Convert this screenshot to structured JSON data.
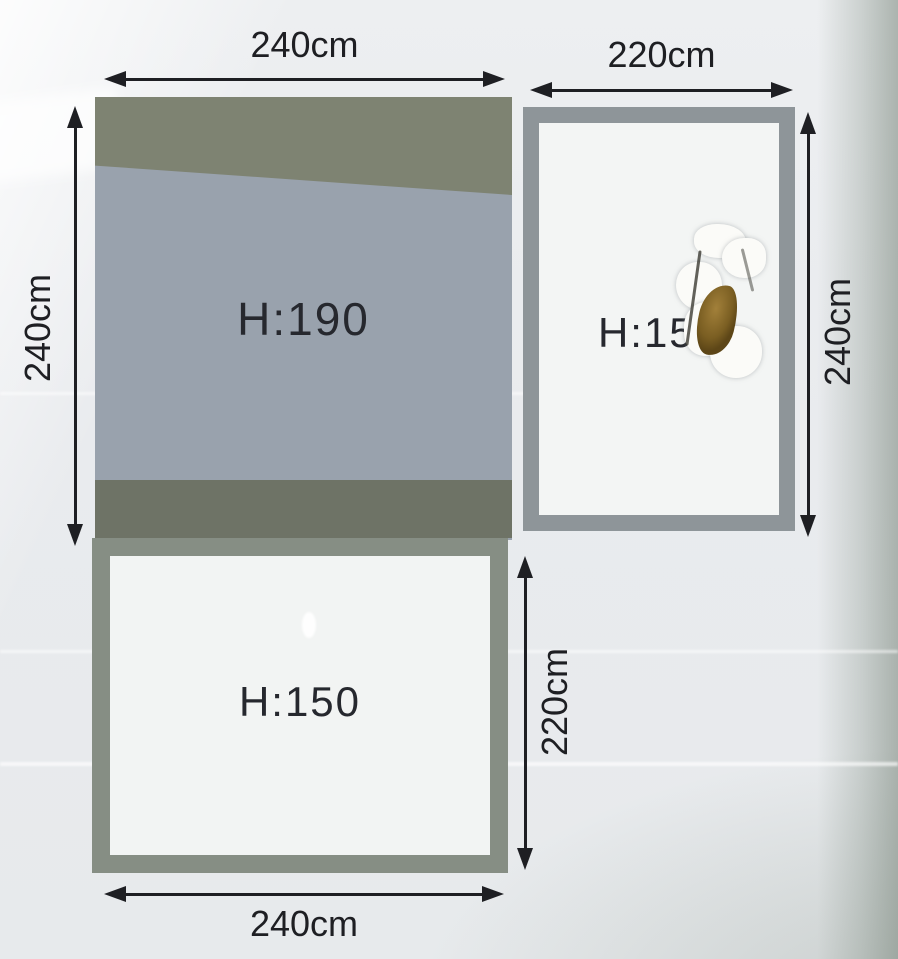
{
  "image": {
    "kind": "package dimension diagram photographed through plastic wrap",
    "background_color": "#e9ebee",
    "ink_color": "#1e1f23"
  },
  "panels": {
    "top_left": {
      "height_label": "H:190",
      "style": "filled",
      "fill": "#99a2ad",
      "top_band": "#7e8372",
      "bottom_band": "#6e7366"
    },
    "top_right": {
      "height_label": "H:150",
      "style": "outlined",
      "border": "#8e9599",
      "interior": "#f3f5f4"
    },
    "bottom_left": {
      "height_label": "H:150",
      "style": "outlined",
      "border": "#868e84",
      "interior": "#f2f4f3"
    }
  },
  "dims": {
    "top_left_width": "240cm",
    "top_right_width": "220cm",
    "left_height": "240cm",
    "right_height": "240cm",
    "middle_height": "220cm",
    "bottom_width": "240cm"
  },
  "defects": {
    "tear": "torn wrap patch with brown spot over right panel label"
  }
}
